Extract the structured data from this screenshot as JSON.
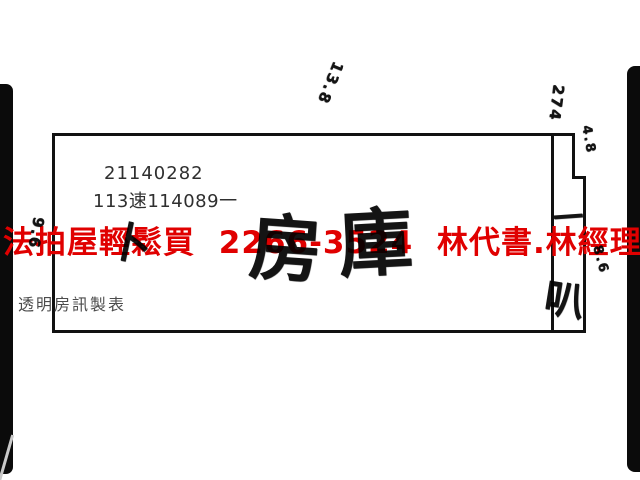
{
  "page": {
    "background": "#ffffff",
    "ink_color": "#141414",
    "accent_red": "#e00000"
  },
  "header": {
    "case_number": "21140282",
    "file_number": "113速114089一"
  },
  "footer": {
    "maker_label": "透明房訊製表"
  },
  "watermark": {
    "full_text": "法拍屋輕鬆買  2266-3524  林代書.林經理",
    "agency": "法拍屋輕鬆買",
    "phone": "2266-3524",
    "contacts": "林代書.林經理"
  },
  "floor_plan": {
    "room_label_left": "房",
    "room_label_right": "庫",
    "side_column_char": "叭",
    "side_column_dash": "一",
    "stray_mark": "卜",
    "annotations": [
      {
        "id": "depth-top",
        "text": "13.8"
      },
      {
        "id": "top-right",
        "text": "274"
      },
      {
        "id": "notch-side",
        "text": "4.8"
      },
      {
        "id": "right-side",
        "text": "8.6"
      },
      {
        "id": "left-side",
        "text": "9.6"
      }
    ]
  }
}
